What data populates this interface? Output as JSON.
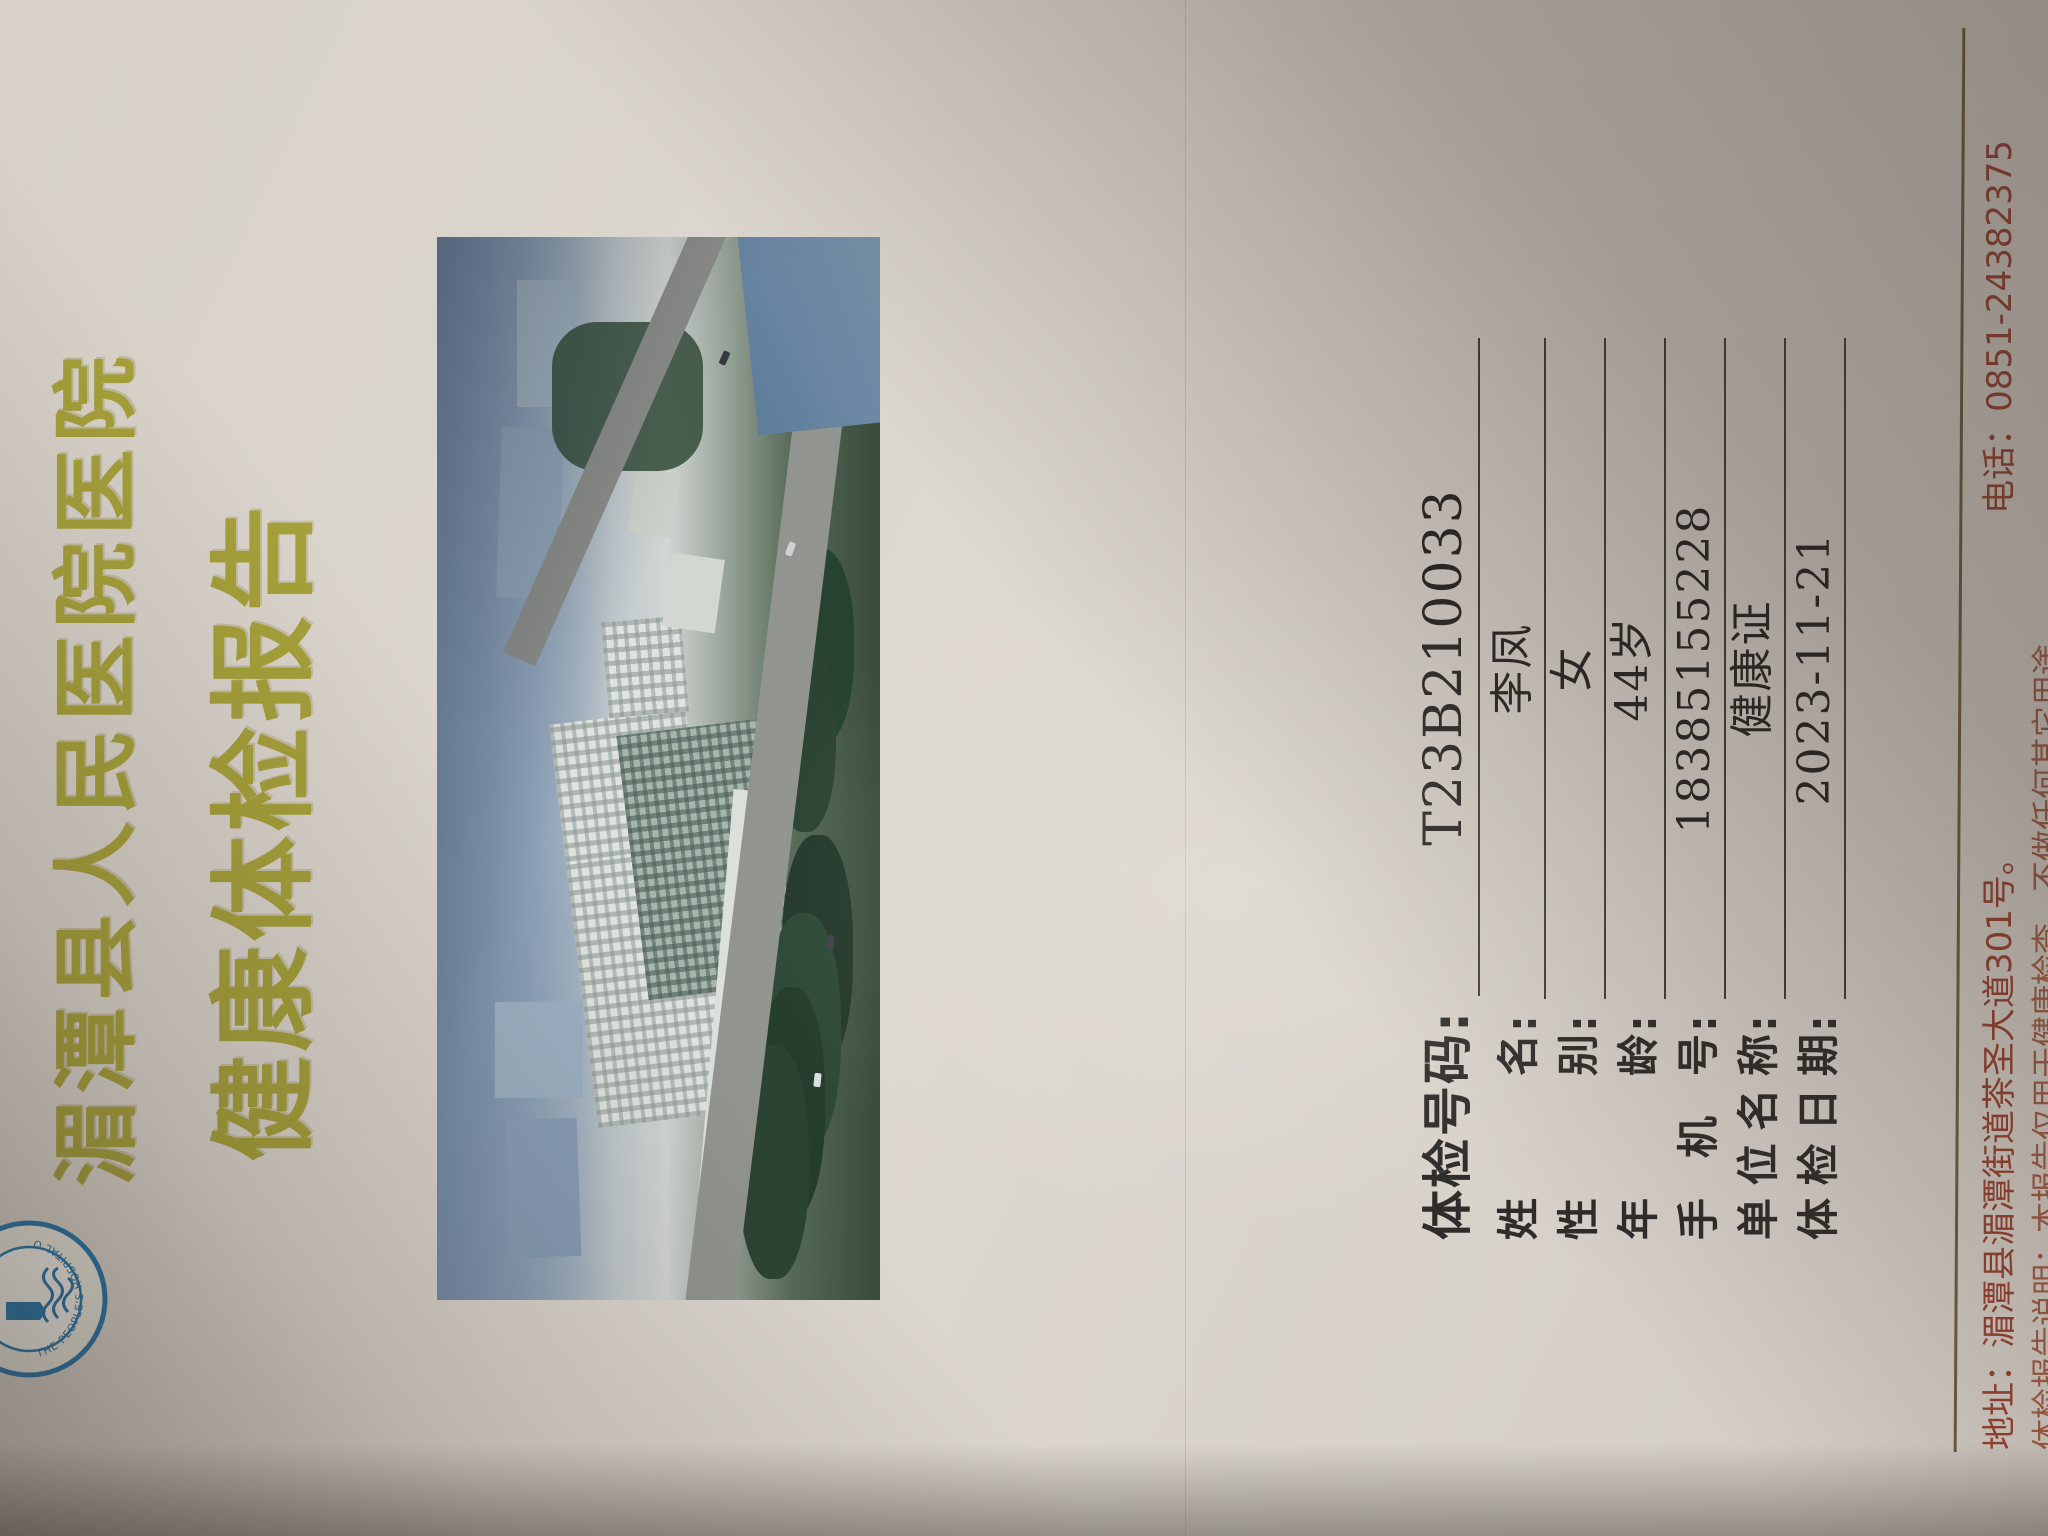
{
  "document": {
    "hospital_name": "湄潭县人民医院医院",
    "report_title": "健康体检报告",
    "logo": {
      "rim_text": "THE PEOPLE'S HOSPITAL OF MEITAN",
      "year": "1951",
      "color": "#2576aa"
    },
    "form": {
      "colon": ":",
      "rows": [
        {
          "label": "体检号码",
          "value": "T23B210033"
        },
        {
          "label": "姓名",
          "value": "李凤"
        },
        {
          "label": "性别",
          "value": "女"
        },
        {
          "label": "年龄",
          "value": "44岁"
        },
        {
          "label": "手机号",
          "value": "18385155228"
        },
        {
          "label": "单位名称",
          "value": "健康证"
        },
        {
          "label": "体检日期",
          "value": "2023-11-21"
        }
      ]
    },
    "footer": {
      "address": "地址：湄潭县湄潭街道茶圣大道301号。",
      "phone": "电话：0851-24382375",
      "disclaimer": "体检报告说明：本报告仅用于健康检查，不做任何其它用途"
    },
    "colors": {
      "title_gold": "#a6a139",
      "footer_red": "#96412f",
      "paper": "#d8d2c9"
    }
  }
}
